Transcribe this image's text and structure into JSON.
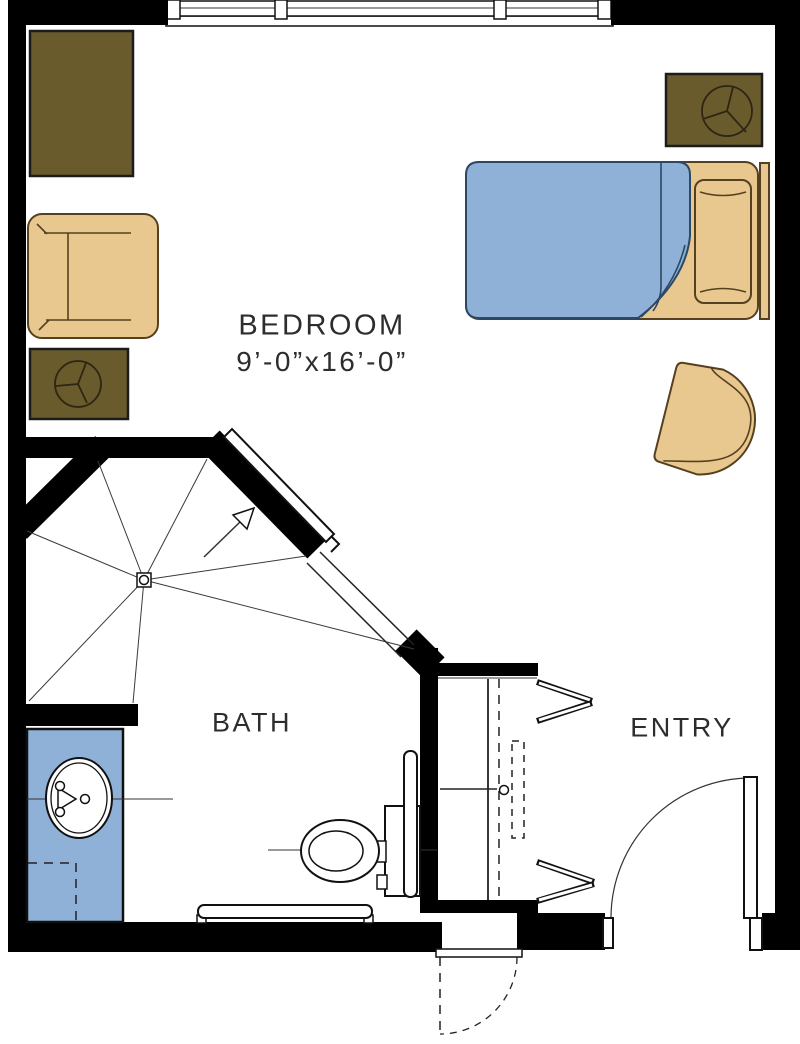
{
  "rooms": [
    {
      "name": "bedroom",
      "label": "BEDROOM",
      "dimensions": "9’-0”x16’-0”"
    },
    {
      "name": "bath",
      "label": "BATH"
    },
    {
      "name": "entry",
      "label": "ENTRY"
    }
  ],
  "colors": {
    "background": "#ffffff",
    "wall": "#000000",
    "furniture_tan": "#e9c890",
    "furniture_tan_border": "#55411f",
    "furniture_olive": "#6a5b2d",
    "fixture_blue": "#8fb1d8",
    "blanket_border": "#2c4864",
    "text": "#2d2d2d"
  }
}
